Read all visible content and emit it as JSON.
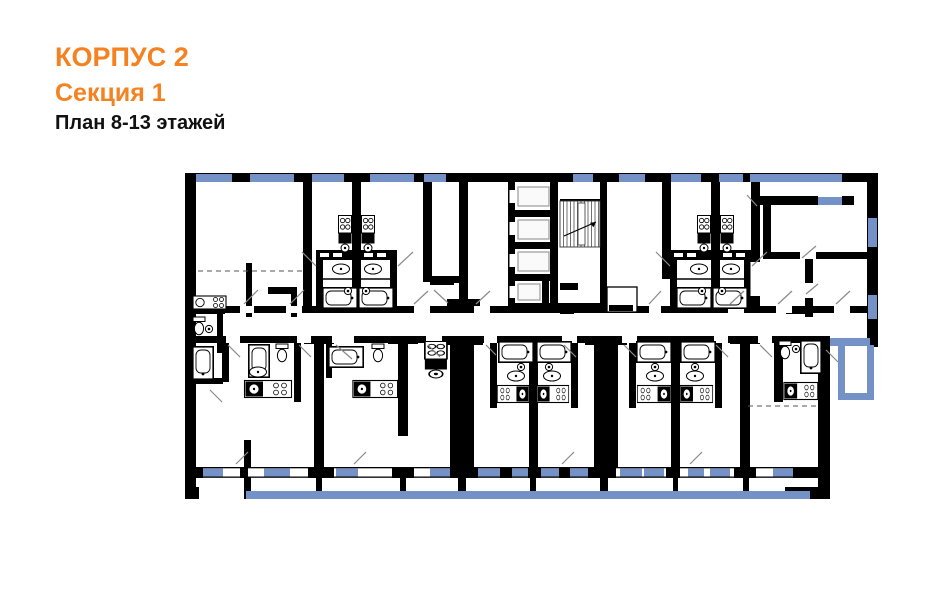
{
  "header": {
    "building": "КОРПУС 2",
    "section": "Секция 1",
    "plan_label": "План 8-13 этажей"
  },
  "colors": {
    "accent_orange": "#F58220",
    "window_blue": "#7492C8",
    "wall_black": "#000000",
    "door_line_gray": "#8a8a8a",
    "dash_gray": "#555555",
    "background": "#FFFFFF"
  }
}
